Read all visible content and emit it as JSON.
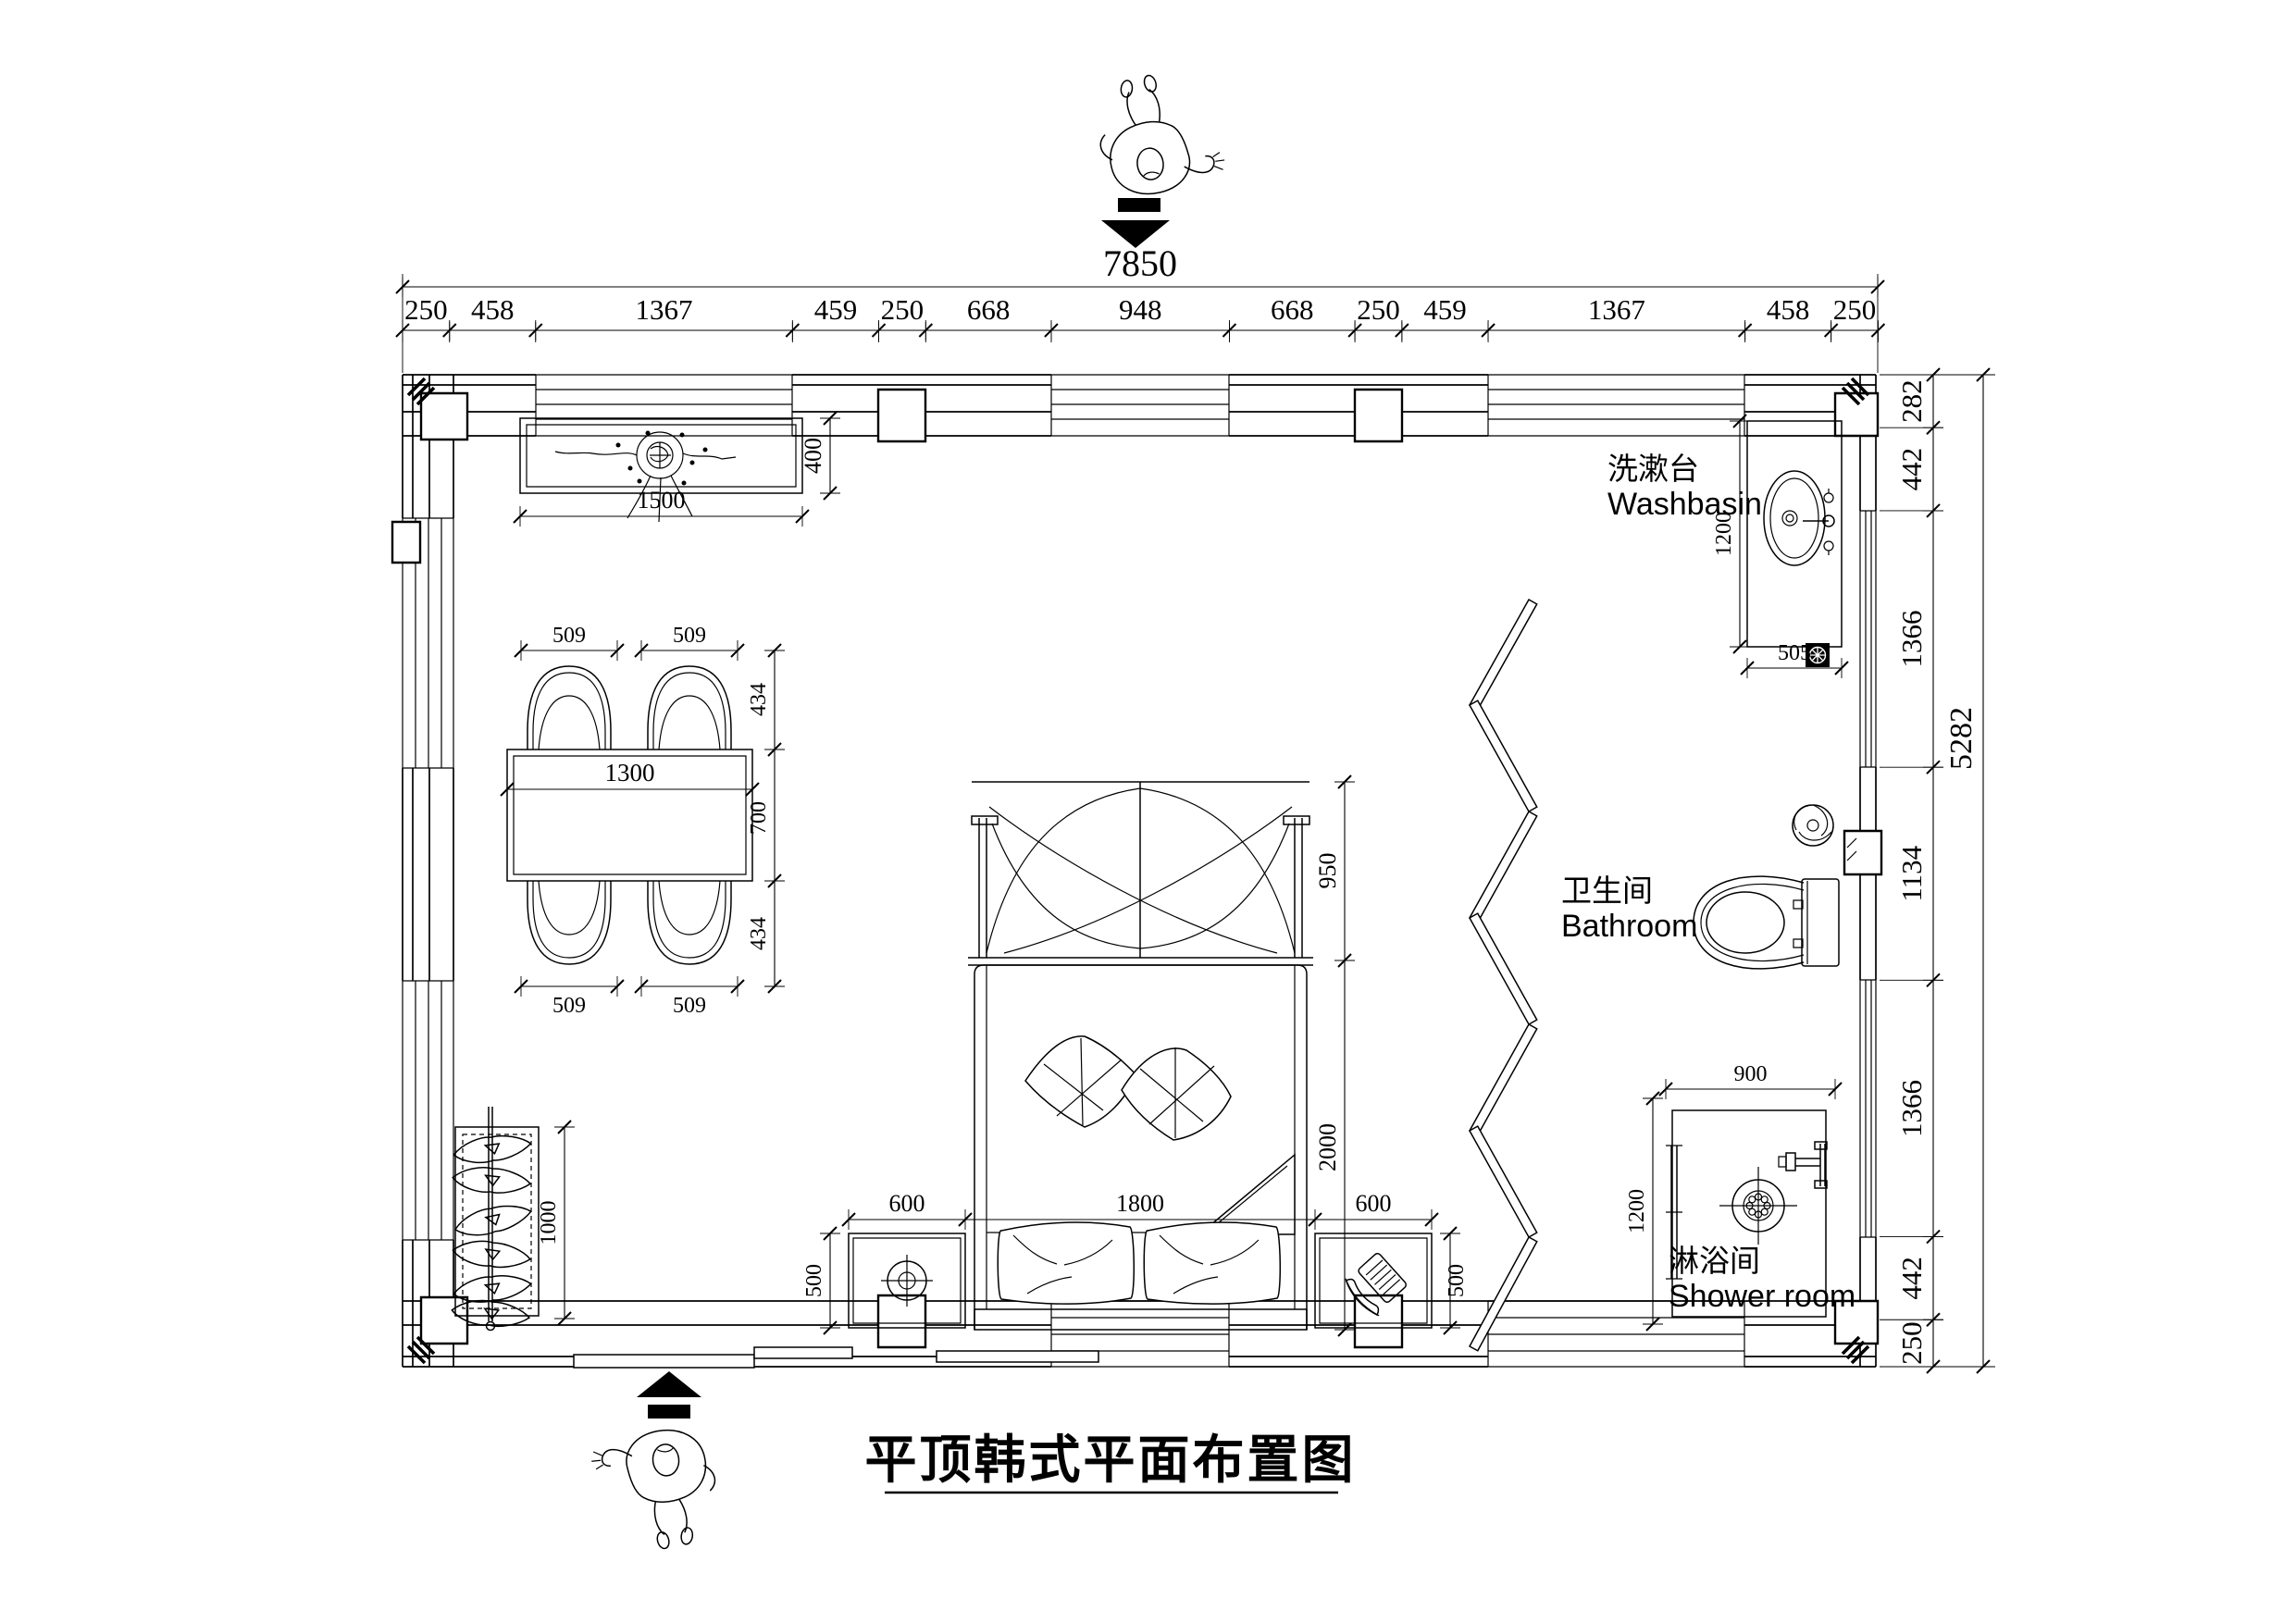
{
  "title": "平顶韩式平面布置图",
  "top_chain": {
    "overall": "7850",
    "segments": [
      "250",
      "458",
      "1367",
      "459",
      "250",
      "668",
      "948",
      "668",
      "250",
      "459",
      "1367",
      "458",
      "250"
    ]
  },
  "right_chain": {
    "overall": "5282",
    "segments": [
      "282",
      "442",
      "1366",
      "1134",
      "1366",
      "442",
      "250"
    ]
  },
  "rooms": {
    "washbasin": {
      "zh": "洗漱台",
      "en": "Washbasin"
    },
    "bathroom": {
      "zh": "卫生间",
      "en": "Bathroom"
    },
    "shower": {
      "zh": "淋浴间",
      "en": "Shower room"
    }
  },
  "dims": {
    "shelf_width": "1500",
    "shelf_depth": "400",
    "chair_tl": "509",
    "chair_tr": "509",
    "chair_bl": "509",
    "chair_br": "509",
    "chair_depth_top": "434",
    "table_depth": "700",
    "chair_depth_bottom": "434",
    "table_length": "1300",
    "nightstand_left_width": "600",
    "bed_width": "1800",
    "nightstand_right_width": "600",
    "canopy_depth": "950",
    "bed_length": "2000",
    "nightstand_left_depth": "500",
    "nightstand_right_depth": "500",
    "wardrobe_length": "1000",
    "washbasin_counter_length": "1200",
    "washbasin_counter_width": "505",
    "shower_width": "900",
    "shower_depth": "1200"
  }
}
